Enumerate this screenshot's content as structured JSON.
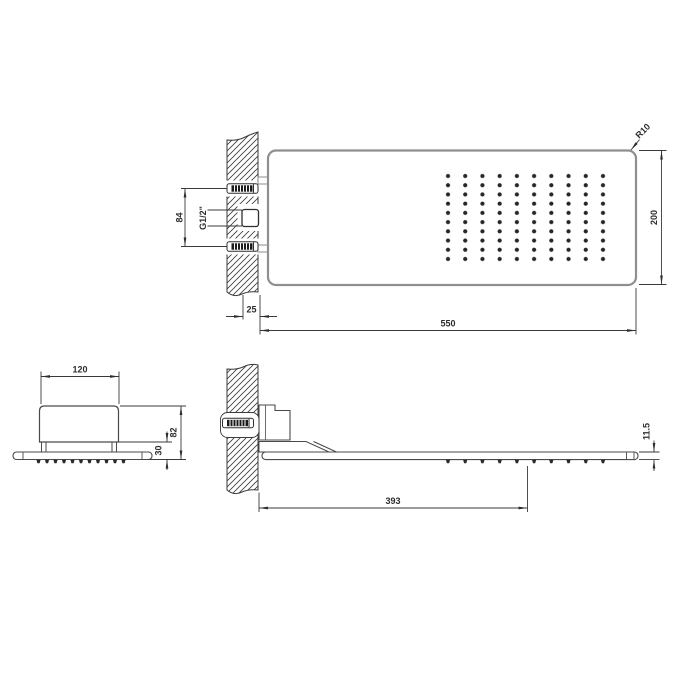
{
  "drawing": {
    "type": "technical-drawing",
    "subject": "wall-mounted rectangular shower head, three orthographic dimensioned views",
    "front_view": {
      "dim_width": "550",
      "dim_height": "200",
      "dim_corner_radius": "R10",
      "dim_wall_offset": "25",
      "dim_fixing_spacing": "84",
      "label_connection": "G1/2\"",
      "nozzle_grid": {
        "columns": 10,
        "rows": 10
      }
    },
    "end_view": {
      "dim_body_width": "120",
      "dim_total_height": "82",
      "dim_plate_drop": "30"
    },
    "side_view": {
      "dim_projection": "393",
      "dim_plate_thickness": "11.5"
    },
    "colors": {
      "dimension_lines": "#3a3a3a",
      "object_outline": "#8f8f8f",
      "detail_outline": "#4a4a4a",
      "nozzle_dots": "#262626",
      "background": "#ffffff"
    }
  }
}
